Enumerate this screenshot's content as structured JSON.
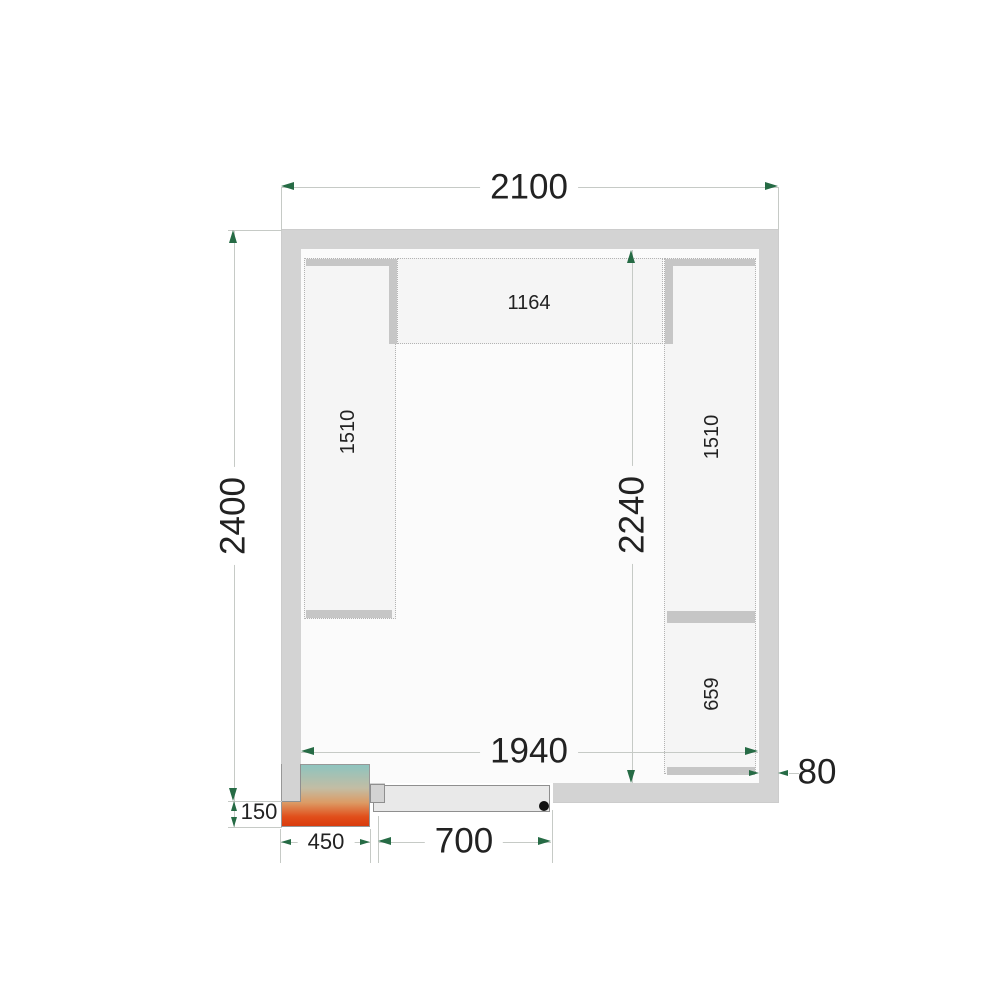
{
  "dimensions": {
    "outer_width": "2100",
    "outer_depth": "2400",
    "inner_width": "1940",
    "inner_depth": "2240",
    "wall_thickness": "80",
    "unit_protrusion": "150",
    "unit_width": "450",
    "door_width": "700"
  },
  "shelving": {
    "left_run_length": "1510",
    "back_run_length": "1164",
    "right_run_length": "1510",
    "right_front_run_length": "659"
  },
  "colors": {
    "wall": "#d3d3d3",
    "floor": "#fbfbfb",
    "shelf_fill": "#f5f5f5",
    "shelf_border": "#b3b3b3",
    "shelf_bar": "#c6c6c6",
    "dim_line": "#c6cac6",
    "arrow": "#266b45",
    "text": "#222222",
    "door_leaf": "#e9e9e9",
    "edge": "#8f8f8f",
    "handle": "#111111",
    "unit_teal": "#8ec4bf",
    "unit_tan": "#c3bda4",
    "unit_amber": "#dc9a64",
    "unit_orange": "#e14e1a",
    "unit_red": "#d93b0d"
  }
}
